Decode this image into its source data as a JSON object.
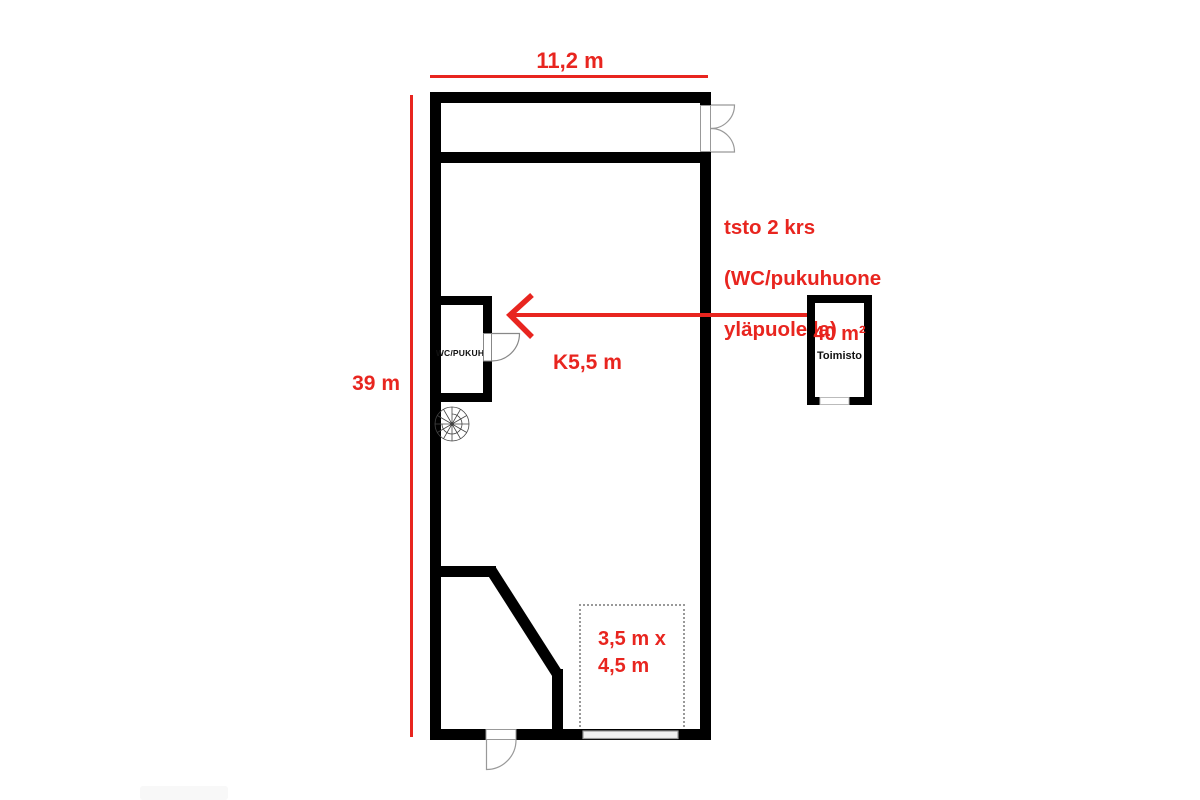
{
  "colors": {
    "accent": "#e8251f",
    "wall": "#000000",
    "door_line": "#999999"
  },
  "dimensions": {
    "building_width": "11,2 m",
    "building_height": "39 m",
    "ceiling_height": "K5,5 m",
    "slot_line1": "3,5 m x",
    "slot_line2": "4,5 m"
  },
  "annotation": {
    "line1": "tsto 2 krs",
    "line2": "(WC/pukuhuone",
    "line3": "yläpuolella)"
  },
  "rooms": {
    "wc": {
      "label": "WC/PUKUH"
    },
    "office": {
      "area": "40 m²",
      "name": "Toimisto"
    }
  }
}
